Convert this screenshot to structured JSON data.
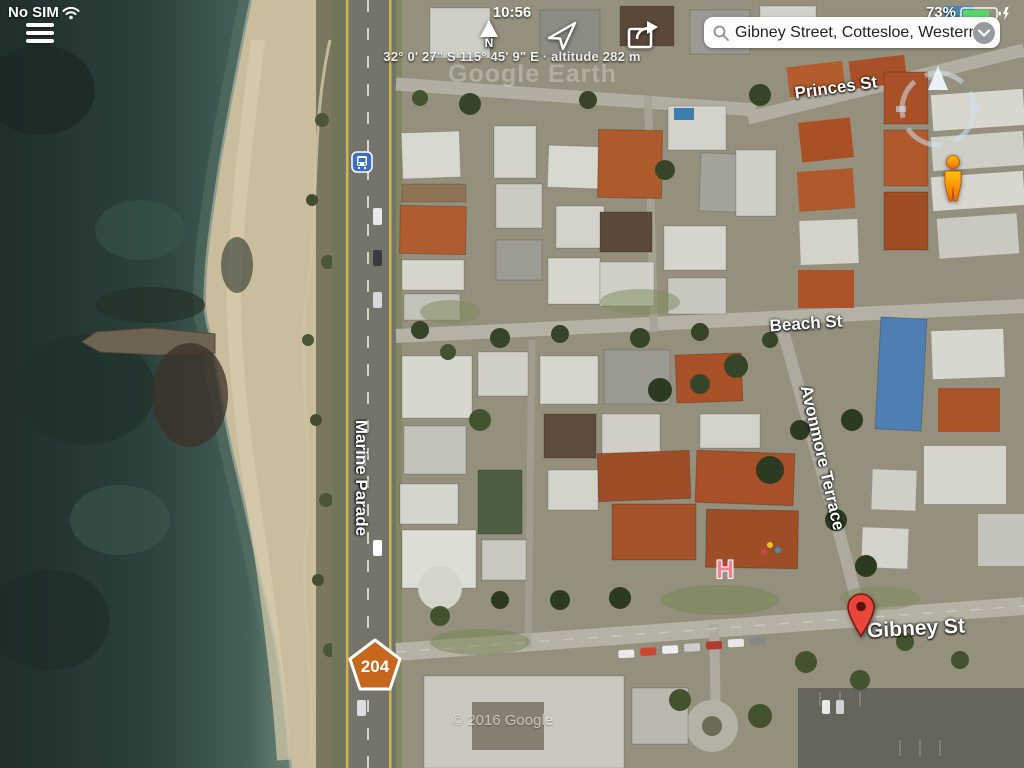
{
  "status_bar": {
    "carrier": "No SIM",
    "time": "10:56",
    "battery_percent": "73%"
  },
  "toolbar": {
    "north_label": "N",
    "coordinates": "32° 0' 27\" S  115° 45' 9\" E · altitude 282 m"
  },
  "search": {
    "value": "Gibney Street, Cottesloe, Western..."
  },
  "map": {
    "labels": {
      "princes_st": "Princes St",
      "beach_st": "Beach St",
      "marine_parade": "Marine Parade",
      "avonmore_terrace": "Avonmore Terrace",
      "gibney_st": "Gibney St"
    },
    "markers": {
      "route_shield": "204",
      "hospital": "H"
    },
    "watermark": "Google Earth",
    "copyright": "© 2016 Google"
  },
  "colors": {
    "battery_green": "#53d769",
    "shield_orange": "#c5671d",
    "pin_red": "#e8463a",
    "transit_blue": "#3a6fc4",
    "hospital_pink": "#ef8193",
    "ocean_deep": "#24332f",
    "road_yellow": "#cdb743"
  }
}
